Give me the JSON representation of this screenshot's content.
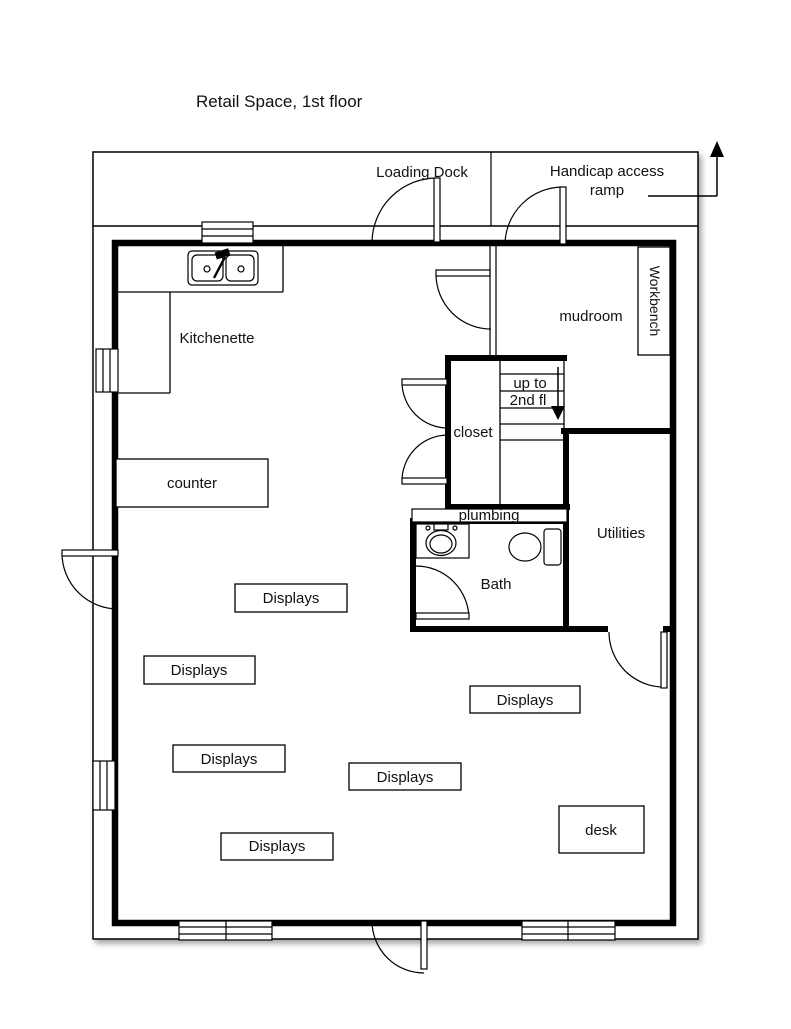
{
  "title": "Retail Space, 1st floor",
  "colors": {
    "line": "#000000",
    "background": "#ffffff",
    "text": "#111111"
  },
  "exterior": {
    "loading_dock": "Loading Dock",
    "handicap_line1": "Handicap access",
    "handicap_line2": "ramp"
  },
  "rooms": {
    "kitchenette": "Kitchenette",
    "mudroom": "mudroom",
    "workbench": "Workbench",
    "closet": "closet",
    "bath": "Bath",
    "utilities": "Utilities",
    "plumbing": "plumbing",
    "stairs_line1": "up to",
    "stairs_line2": "2nd fl"
  },
  "furniture": {
    "counter": "counter",
    "desk": "desk",
    "displays": [
      "Displays",
      "Displays",
      "Displays",
      "Displays",
      "Displays",
      "Displays"
    ]
  }
}
